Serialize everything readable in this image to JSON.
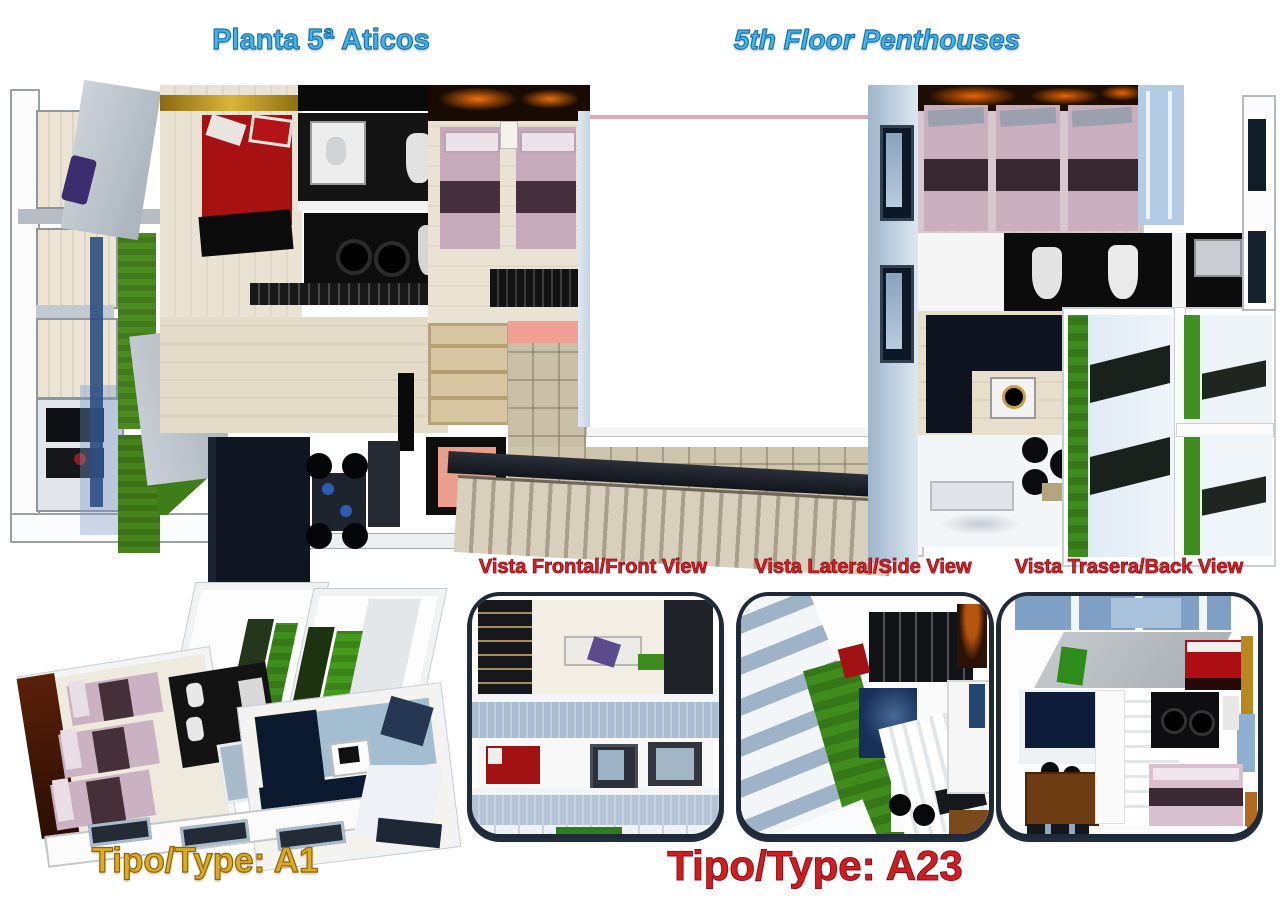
{
  "header": {
    "title_es": "Planta 5ª Aticos",
    "title_en": "5th Floor Penthouses"
  },
  "views": {
    "front": "Vista Frontal/Front View",
    "side": "Vista Lateral/Side View",
    "back": "Vista Trasera/Back View"
  },
  "types": {
    "a1": "Tipo/Type: A1",
    "a23": "Tipo/Type: A23"
  },
  "colors": {
    "title_blue": "#45b5e8",
    "title_blue_outline": "#1a72ad",
    "label_red": "#db2026",
    "type_gold": "#dfaa1e",
    "type_red": "#d01d22"
  }
}
